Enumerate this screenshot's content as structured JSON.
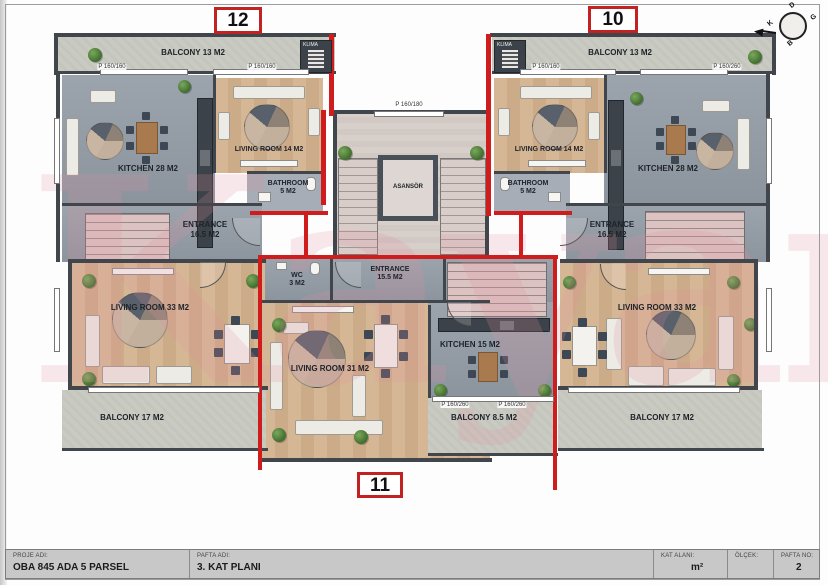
{
  "units": {
    "u12": "12",
    "u10": "10",
    "u11": "11"
  },
  "compass": {
    "north": "K",
    "east": "D",
    "south": "G",
    "west": "B"
  },
  "watermark": "Kayan",
  "rooms": {
    "balcony13_left": {
      "label": "BALCONY 13 M2"
    },
    "balcony13_right": {
      "label": "BALCONY 13 M2"
    },
    "kitchen28_left": {
      "label": "KITCHEN 28 M2"
    },
    "kitchen28_right": {
      "label": "KITCHEN 28 M2"
    },
    "living14_left": {
      "label": "LIVING ROOM 14 M2"
    },
    "living14_right": {
      "label": "LIVING ROOM 14 M2"
    },
    "bathroom_left": {
      "line1": "BATHROOM",
      "line2": "5 M2"
    },
    "bathroom_right": {
      "line1": "BATHROOM",
      "line2": "5 M2"
    },
    "entrance_left": {
      "line1": "ENTRANCE",
      "line2": "16.5 M2"
    },
    "entrance_right": {
      "line1": "ENTRANCE",
      "line2": "16.5 M2"
    },
    "entrance_mid": {
      "line1": "ENTRANCE",
      "line2": "15.5 M2"
    },
    "wc": {
      "line1": "WC",
      "line2": "3 M2"
    },
    "living31": {
      "label": "LIVING ROOM 31 M2"
    },
    "kitchen15": {
      "label": "KITCHEN 15 M2"
    },
    "balcony85": {
      "label": "BALCONY 8.5 M2"
    },
    "living33_left": {
      "label": "LIVING ROOM 33 M2"
    },
    "living33_right": {
      "label": "LIVING ROOM 33 M2"
    },
    "balcony17_left": {
      "label": "BALCONY 17 M2"
    },
    "balcony17_right": {
      "label": "BALCONY 17 M2"
    },
    "elevator": {
      "label": "ASANSÖR"
    },
    "klima_left": {
      "label": "KLIMA"
    },
    "klima_right": {
      "label": "KLIMA"
    }
  },
  "windows": {
    "w1": "P 160/160",
    "w2": "P 160/160",
    "w3": "P 160/180",
    "w4": "P 160/160",
    "w5": "P 160/260",
    "w6": "P 160/260",
    "w7": "P 160/260"
  },
  "title_block": {
    "proje_adi_label": "PROJE ADI:",
    "proje_adi": "OBA 845 ADA 5 PARSEL",
    "pafta_adi_label": "PAFTA ADI:",
    "pafta_adi": "3. KAT PLANI",
    "kat_alani_label": "KAT ALANI:",
    "kat_alani": "m²",
    "olcek_label": "ÖLÇEK:",
    "olcek": "",
    "pafta_no_label": "PAFTA NO:",
    "pafta_no": "2"
  },
  "colors": {
    "red_wall": "#cf1d1d",
    "dark_wall": "#41464d",
    "wood_floor": "#d2b291",
    "concrete": "#c9cbc3",
    "interior_gray": "#939ca6",
    "marble": "#d7cfca",
    "stair_pink": "#dcc2c1",
    "watermark_pink": "#e291a0"
  }
}
